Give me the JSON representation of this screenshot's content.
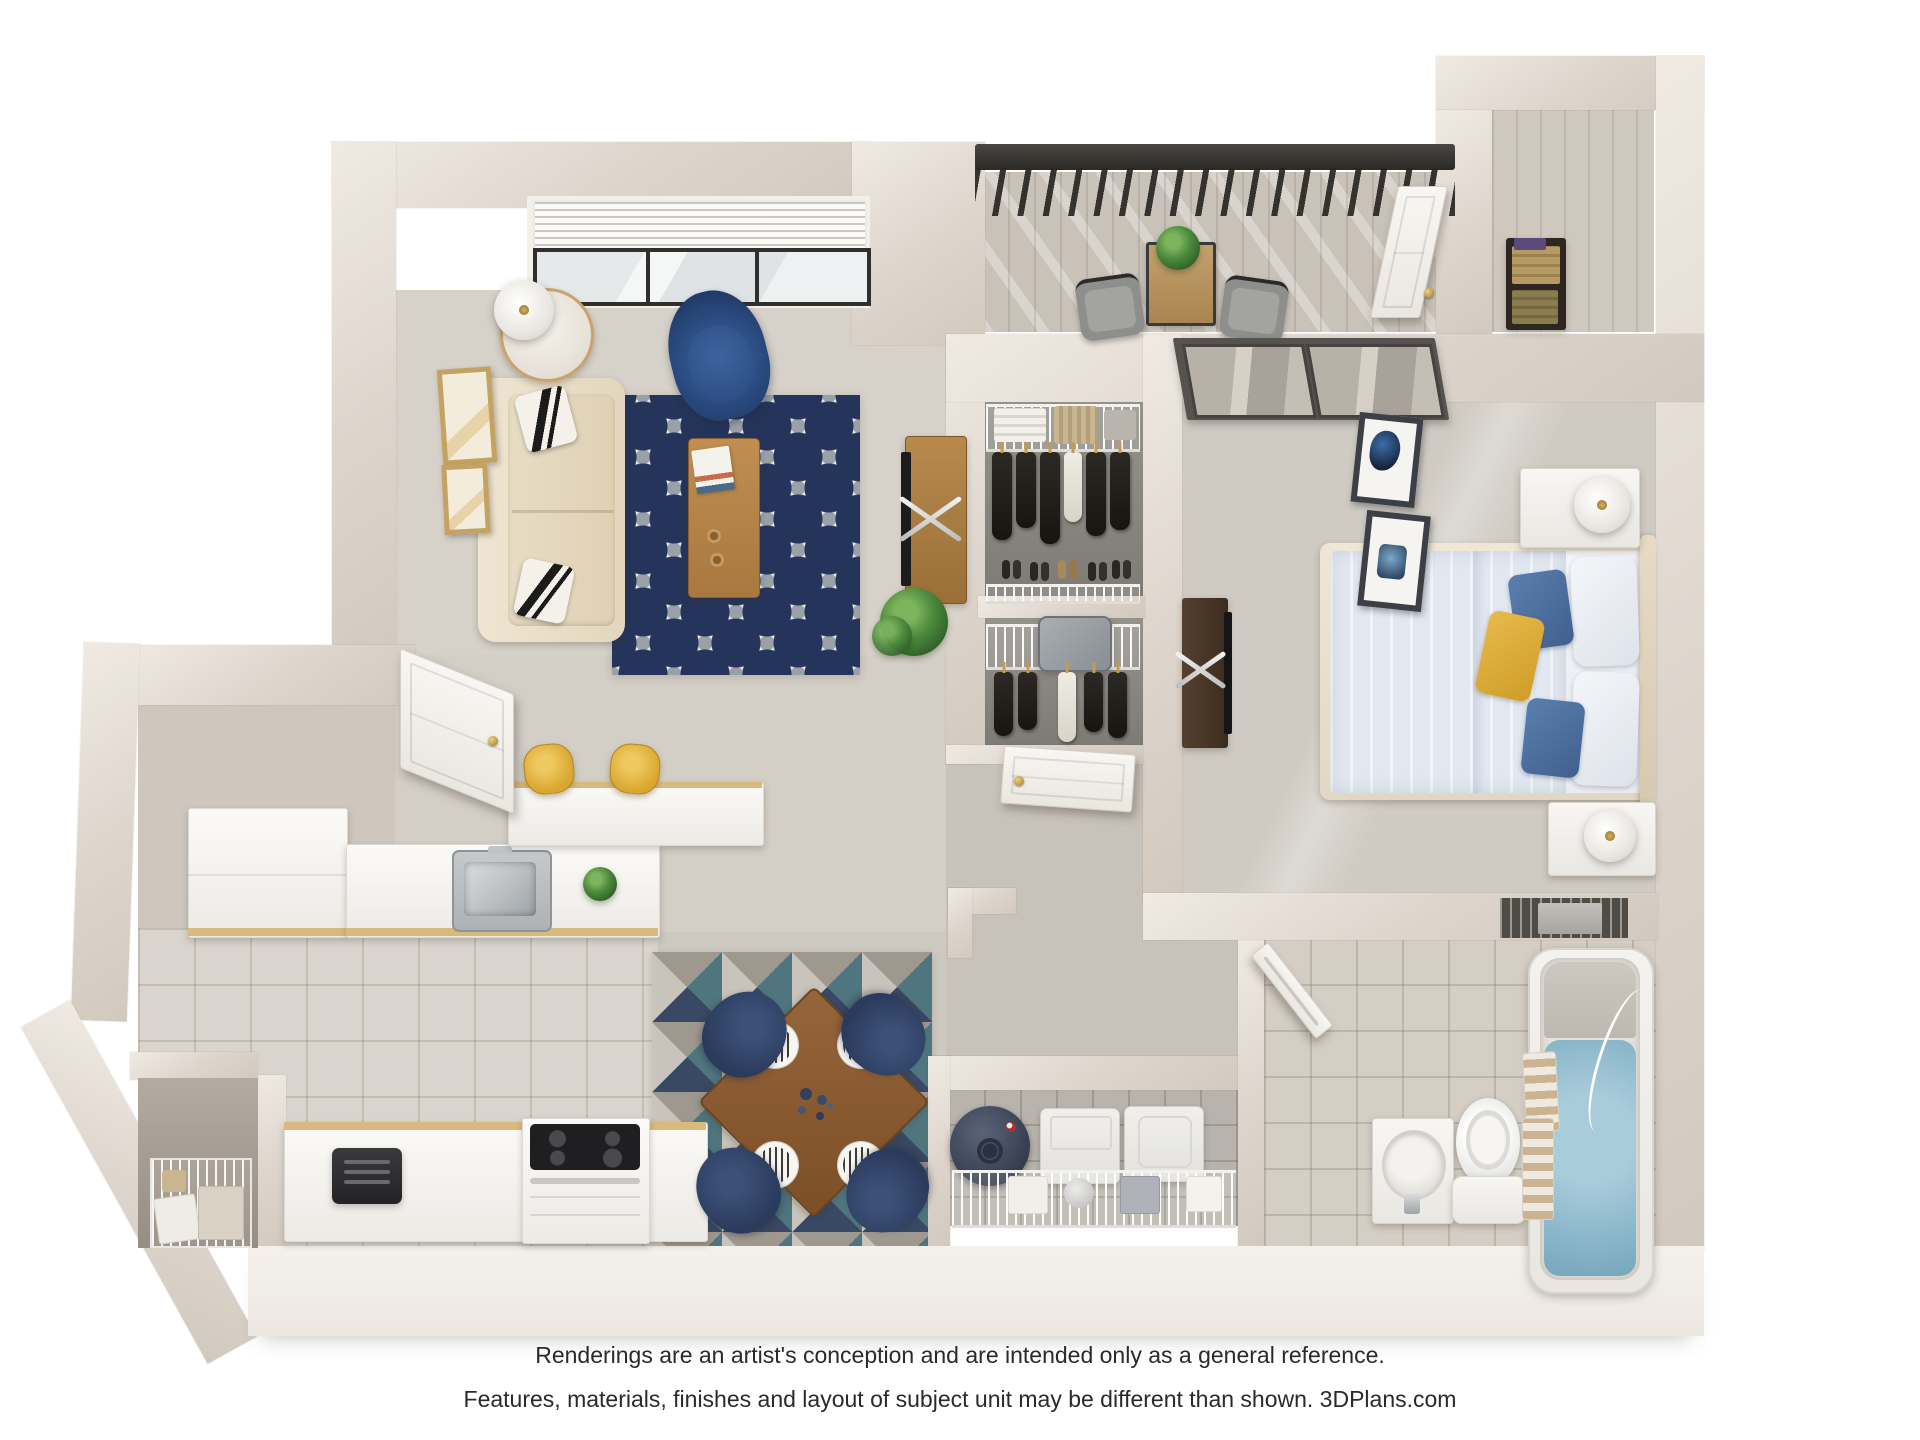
{
  "page": {
    "background": "#ffffff",
    "content_type": "3D top-down apartment floor plan rendering"
  },
  "disclaimer": {
    "line1": "Renderings are an artist's conception and are intended only as a general reference.",
    "line2": "Features, materials, finishes and layout of subject unit may be different than shown. 3DPlans.com",
    "brand": "3DPlans.com"
  },
  "palette": {
    "wall_face": "#d9d1c8",
    "wall_top": "#efe9e2",
    "wall_outer": "#f3efe9",
    "carpet_living": "#d6d1c9",
    "carpet_hall": "#c7c2ba",
    "carpet_bedroom": "#cfcac2",
    "closet_floor": "#8f8b84",
    "tile_kitchen": "#d9d5ce",
    "tile_bath": "#d4cec4",
    "tile_laundry": "#b8b4ad",
    "balcony_wood": "#c9c2b8",
    "rug_navy": "#25345a",
    "rug_gray": "#99a0a8",
    "rug_teal": "#46707a",
    "sofa_cream": "#e7dcc7",
    "armchair_blue": "#2e4f86",
    "accent_yellow": "#d9a62e",
    "bed_linen": "#e2e8f1",
    "pillow_blue": "#4f74a6",
    "pillow_yellow": "#ddad3b",
    "wood_furniture": "#b8864b",
    "bath_water": "#8ab6ca",
    "railing": "#35332f",
    "appliance_white": "#ececea",
    "water_heater": "#3b4254",
    "door_white": "#f6f4f0",
    "knob_gold": "#c09a3e"
  },
  "floorplan": {
    "style": "photoreal 3D dollhouse view, one-bedroom / one-bath apartment",
    "rooms": [
      {
        "name": "Living Room",
        "floor": "carpet",
        "furniture": [
          "window-with-blinds",
          "side-table",
          "table-lamp",
          "navy-armchair",
          "cream-sofa",
          "black-white-accent-pillows",
          "navy-quatrefoil-area-rug",
          "wood-coffee-table",
          "magazines",
          "mugs",
          "tv-console",
          "tv",
          "potted-plant",
          "wall-art-tan-frames",
          "entry-door"
        ]
      },
      {
        "name": "Balcony",
        "floor": "wood-plank",
        "furniture": [
          "black-railing",
          "bistro-table",
          "potted-plant",
          "patio-chair",
          "patio-chair",
          "storage-door"
        ]
      },
      {
        "name": "Outdoor Storage",
        "floor": "wood-plank",
        "furniture": [
          "shelf-with-boxes"
        ]
      },
      {
        "name": "Walk-in Closet",
        "floor": "carpet",
        "furniture": [
          "wire-shelf",
          "towels",
          "basket",
          "hanging-clothes",
          "shoe-row"
        ]
      },
      {
        "name": "Second Closet",
        "floor": "carpet",
        "furniture": [
          "wire-shelf",
          "suitcase",
          "hanging-clothes"
        ]
      },
      {
        "name": "Bedroom",
        "floor": "carpet",
        "furniture": [
          "sliding-glass-door",
          "bed-with-blue-bedding",
          "white-pillows",
          "blue-pillows",
          "yellow-accent-pillow",
          "nightstand",
          "table-lamp",
          "nightstand",
          "table-lamp",
          "dresser-with-tv",
          "wall-art-two-frames",
          "wall-niche-shelf",
          "bedroom-door"
        ]
      },
      {
        "name": "Hallway",
        "floor": "carpet",
        "furniture": [
          "bedroom-door",
          "bathroom-door",
          "wall-stub"
        ]
      },
      {
        "name": "Laundry Closet",
        "floor": "tile",
        "furniture": [
          "water-heater",
          "washer",
          "dryer",
          "wire-shelf",
          "storage-boxes"
        ]
      },
      {
        "name": "Bathroom",
        "floor": "tile",
        "furniture": [
          "vanity-with-sink",
          "toilet",
          "towel-stack",
          "bathtub-with-water",
          "draped-towel"
        ]
      },
      {
        "name": "Kitchen",
        "floor": "tile",
        "furniture": [
          "entry-door",
          "upper-cabinet-run",
          "counter-with-sink",
          "stainless-sink",
          "potted-plant",
          "breakfast-bar",
          "bar-stool",
          "bar-stool",
          "lower-counter",
          "toaster",
          "range-with-cooktop",
          "pantry-wire-basket"
        ]
      },
      {
        "name": "Dining Area",
        "floor": "carpet",
        "furniture": [
          "geometric-triangle-rug",
          "wood-dining-table",
          "place-settings",
          "glassware",
          "dining-chair",
          "dining-chair",
          "dining-chair",
          "dining-chair"
        ]
      }
    ]
  }
}
